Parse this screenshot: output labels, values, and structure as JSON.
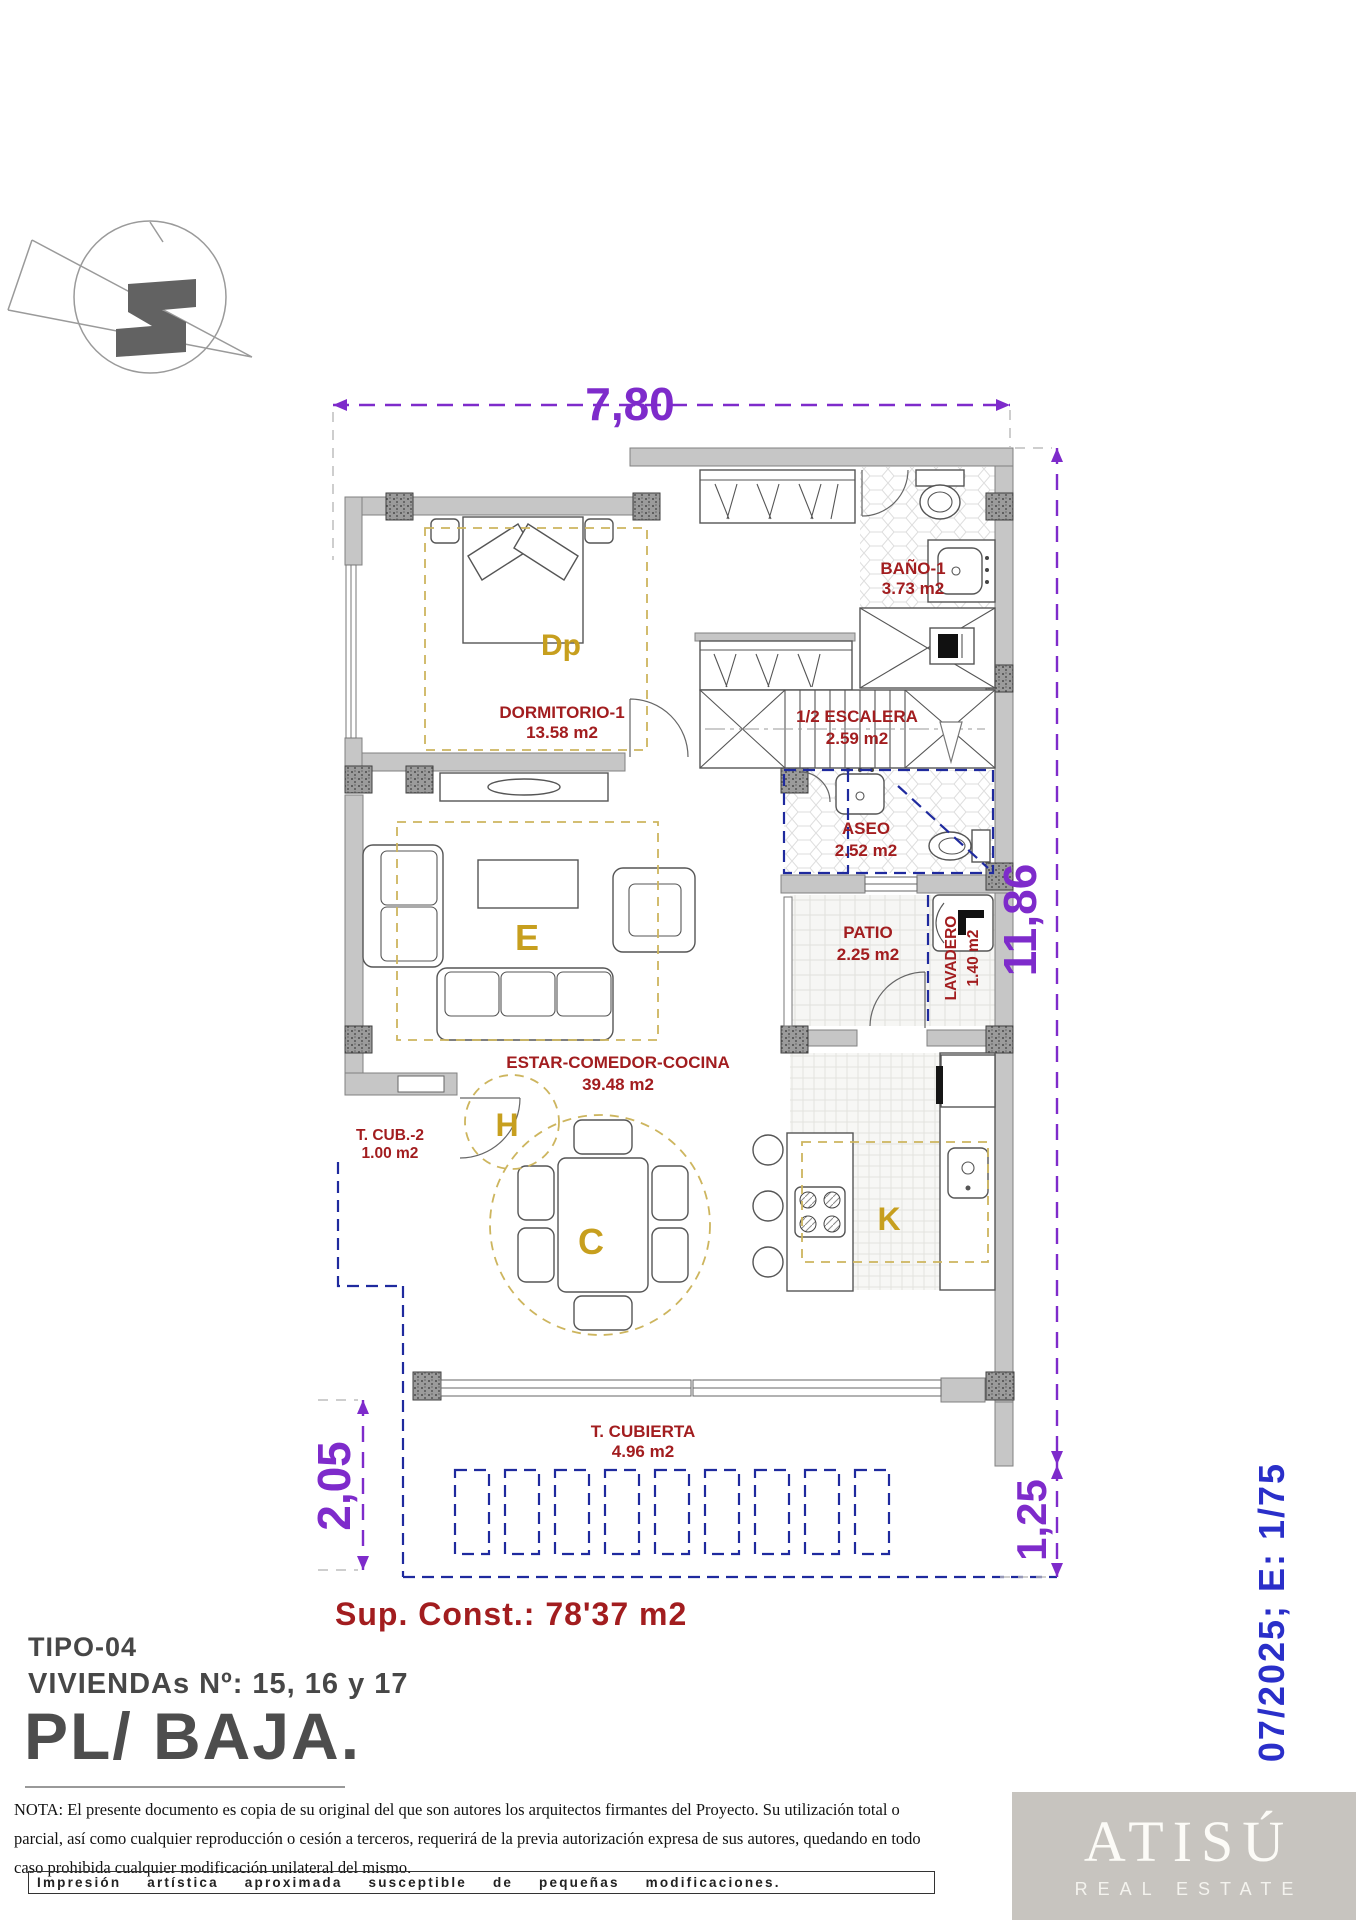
{
  "document": {
    "plan_title": "PL/ BAJA.",
    "type_label": "TIPO-04",
    "units_label": "VIVIENDAs Nº: 15, 16 y 17",
    "built_area": "Sup. Const.: 78'37 m2",
    "scale_note": "07/2025; E: 1/75"
  },
  "dimensions": {
    "top_width": "7,80",
    "right_height": "11,86",
    "terrace_depth_left": "2,05",
    "pergola_depth_right": "1,25"
  },
  "rooms": [
    {
      "name": "BAÑO-1",
      "area": "3.73 m2"
    },
    {
      "name": "DORMITORIO-1",
      "area": "13.58 m2"
    },
    {
      "name": "1/2 ESCALERA",
      "area": "2.59 m2"
    },
    {
      "name": "ASEO",
      "area": "2.52 m2"
    },
    {
      "name": "PATIO",
      "area": "2.25 m2"
    },
    {
      "name": "LAVADERO",
      "area": "1.40 m2"
    },
    {
      "name": "ESTAR-COMEDOR-COCINA",
      "area": "39.48 m2"
    },
    {
      "name": "T. CUB.-2",
      "area": "1.00 m2"
    },
    {
      "name": "T. CUBIERTA",
      "area": "4.96 m2"
    }
  ],
  "zones": {
    "bedroom": "Dp",
    "living": "E",
    "hall": "H",
    "dining": "C",
    "kitchen": "K"
  },
  "footer": {
    "nota": "NOTA: El presente documento es copia de su original del que son autores los arquitectos firmantes del Proyecto. Su utilización total o parcial, así como cualquier reproducción o cesión a terceros, requerirá  de la previa autorización expresa de sus autores, quedando en todo caso prohibida cualquier modificación unilateral del mismo.",
    "disclaimer": "Impresión artística aproximada susceptible de pequeñas modificaciones."
  },
  "logo": {
    "brand": "ATISÚ",
    "tagline": "REAL ESTATE"
  },
  "colors": {
    "dimension_purple": "#7e2bcb",
    "room_label_red": "#a21d1f",
    "zone_letter_gold": "#c79f1e",
    "plan_blue_dash": "#1f2a9e",
    "scale_note_blue": "#2a2fc9",
    "wall_grey": "#c6c6c6",
    "logo_background": "#c7c4bf"
  }
}
